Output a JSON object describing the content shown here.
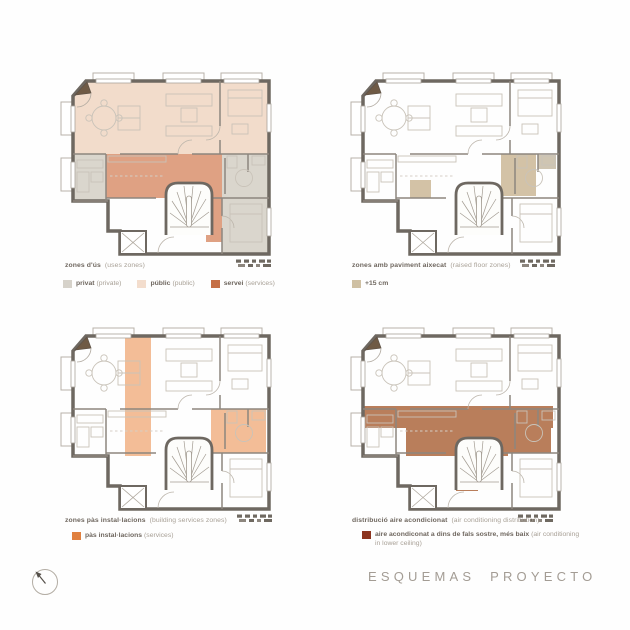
{
  "title": "ESQUEMAS PROYECTO",
  "panels": [
    {
      "name": "uses-zones",
      "caption": "zones d'ús",
      "caption_en": "(uses zones)",
      "legend": [
        {
          "label": "privat",
          "label_en": "(private)",
          "color": "#d6d2ca"
        },
        {
          "label": "públic",
          "label_en": "(public)",
          "color": "#f3ddcd"
        },
        {
          "label": "servei",
          "label_en": "(services)",
          "color": "#c56f46"
        }
      ]
    },
    {
      "name": "raised-floor-zones",
      "caption": "zones amb paviment aixecat",
      "caption_en": "(raised floor zones)",
      "legend": [
        {
          "label": "+15 cm",
          "label_en": "",
          "color": "#cfc0a3"
        }
      ]
    },
    {
      "name": "building-services-zones",
      "caption": "zones pàs instal·lacions",
      "caption_en": "(building services zones)",
      "legend": [
        {
          "label": "pàs instal·lacions",
          "label_en": "(services)",
          "color": "#e0803f"
        }
      ]
    },
    {
      "name": "ac-distribution",
      "caption": "distribució aire acondicionat",
      "caption_en": "(air conditioning distribution)",
      "legend": [
        {
          "label": "aire acondiconat a dins de fals sostre, més baix",
          "label_en": "(air conditioning in lower ceiling)",
          "color": "#8c3520"
        }
      ]
    }
  ],
  "zone_colors": {
    "privat": "#dad6cd",
    "public": "#f2dccb",
    "servei": "#dfa183",
    "raised_floor": "#d3c2a6",
    "services_duct": "#f3bd97",
    "ac_lowered_ceiling": "#b97e5b",
    "walls": "#6e6861"
  }
}
